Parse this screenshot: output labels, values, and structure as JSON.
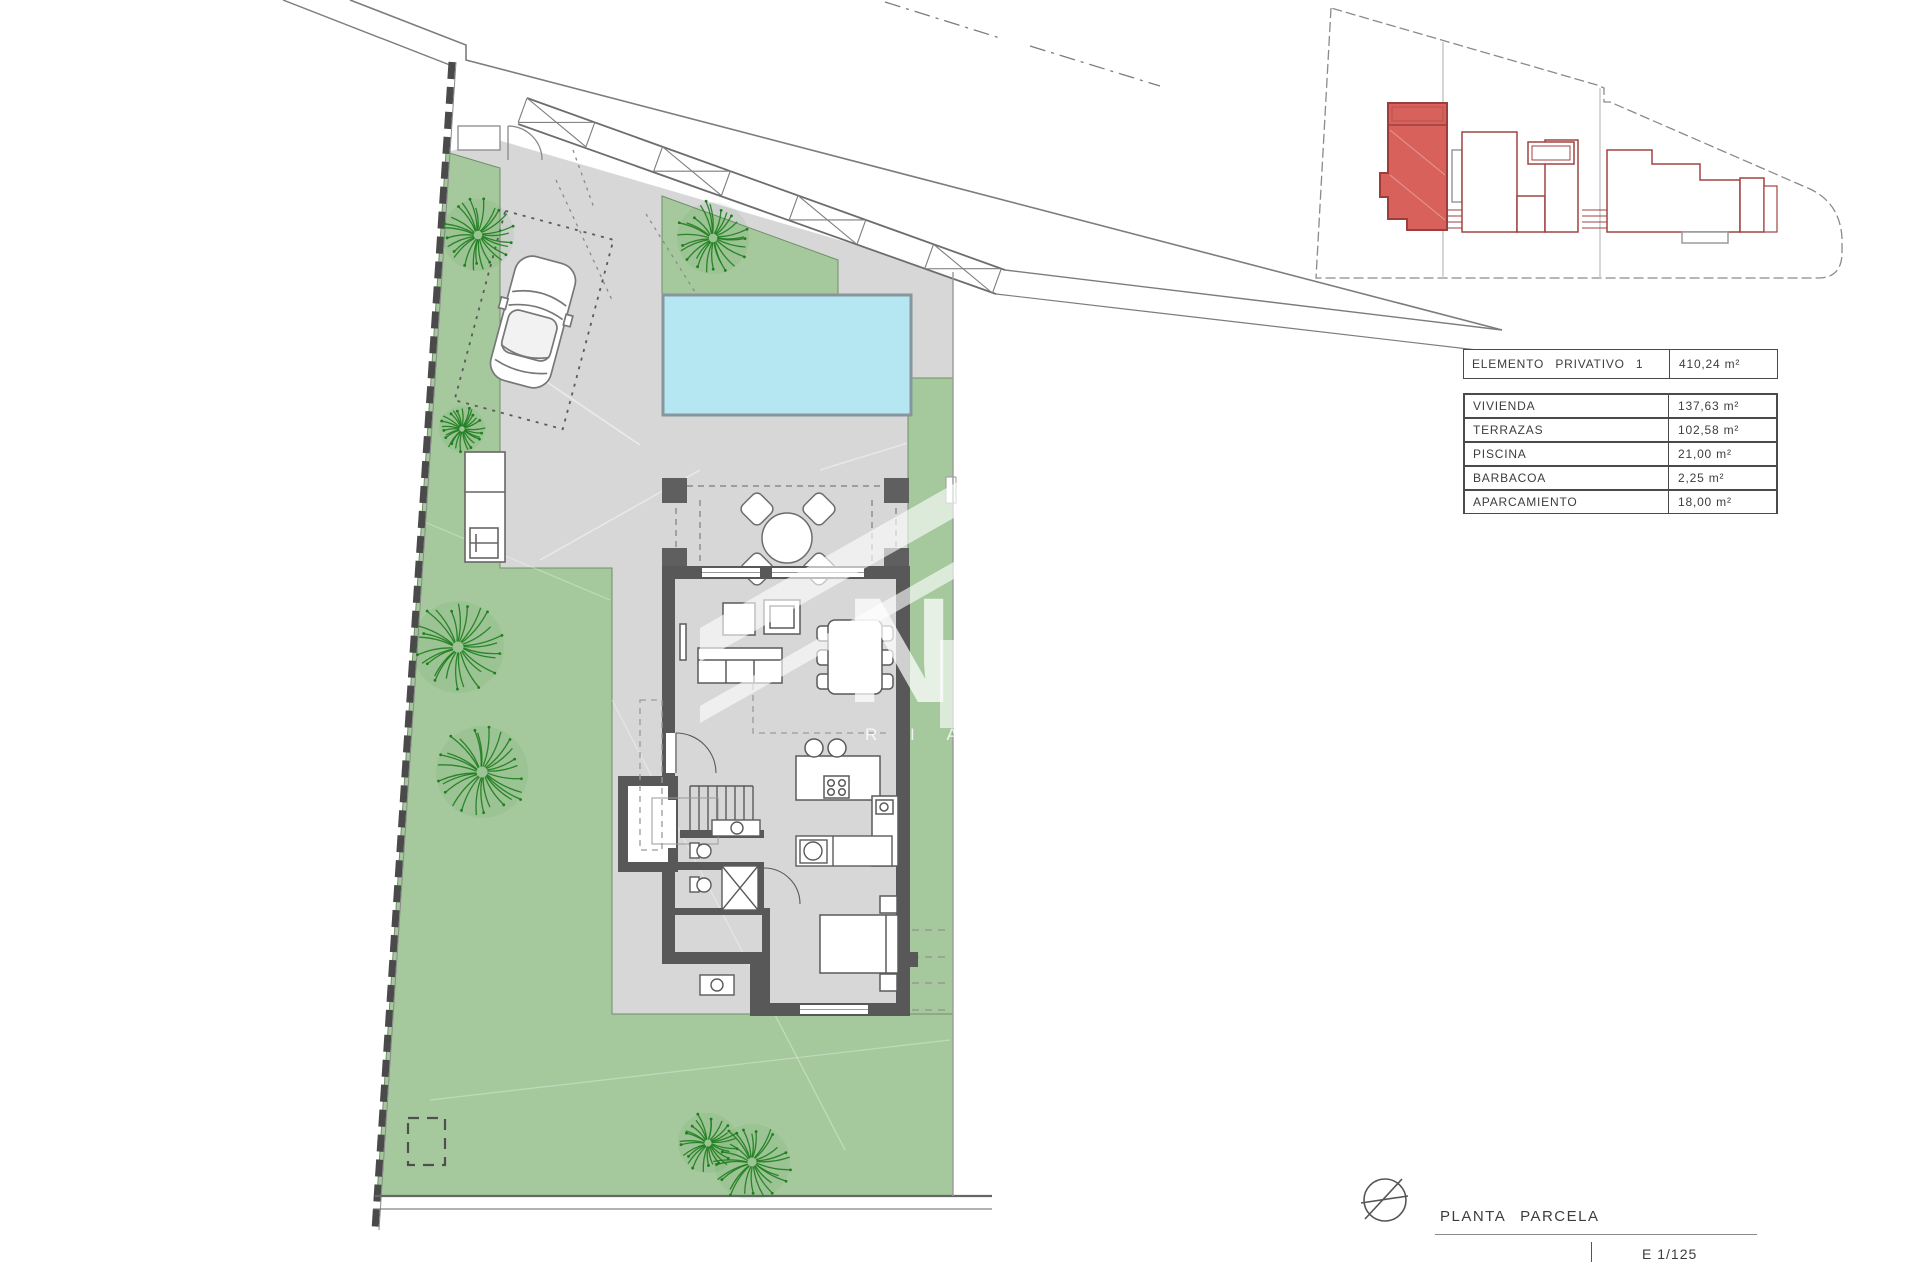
{
  "document": {
    "title_label": "PLANTA PARCELA",
    "scale_label": "E 1/125"
  },
  "legend": {
    "header": {
      "label": "ELEMENTO PRIVATIVO 1",
      "value": "410,24 m²"
    },
    "rows": [
      {
        "label": "VIVIENDA",
        "value": "137,63 m²"
      },
      {
        "label": "TERRAZAS",
        "value": "102,58 m²"
      },
      {
        "label": "PISCINA",
        "value": "21,00 m²"
      },
      {
        "label": "BARBACOA",
        "value": "2,25 m²"
      },
      {
        "label": "APARCAMIENTO",
        "value": "18,00 m²"
      }
    ]
  },
  "watermark": {
    "letter": "N",
    "text": "R I A"
  },
  "colors": {
    "lawn": "#a5c99d",
    "paving": "#d7d7d7",
    "pool": "#b5e7f2",
    "pool_border": "#87969e",
    "wall": "#585858",
    "line": "#7c7c7c",
    "highlight_fill": "#d9615c",
    "highlight_stroke": "#9c3f3c",
    "tree": "#1e7d1e"
  }
}
